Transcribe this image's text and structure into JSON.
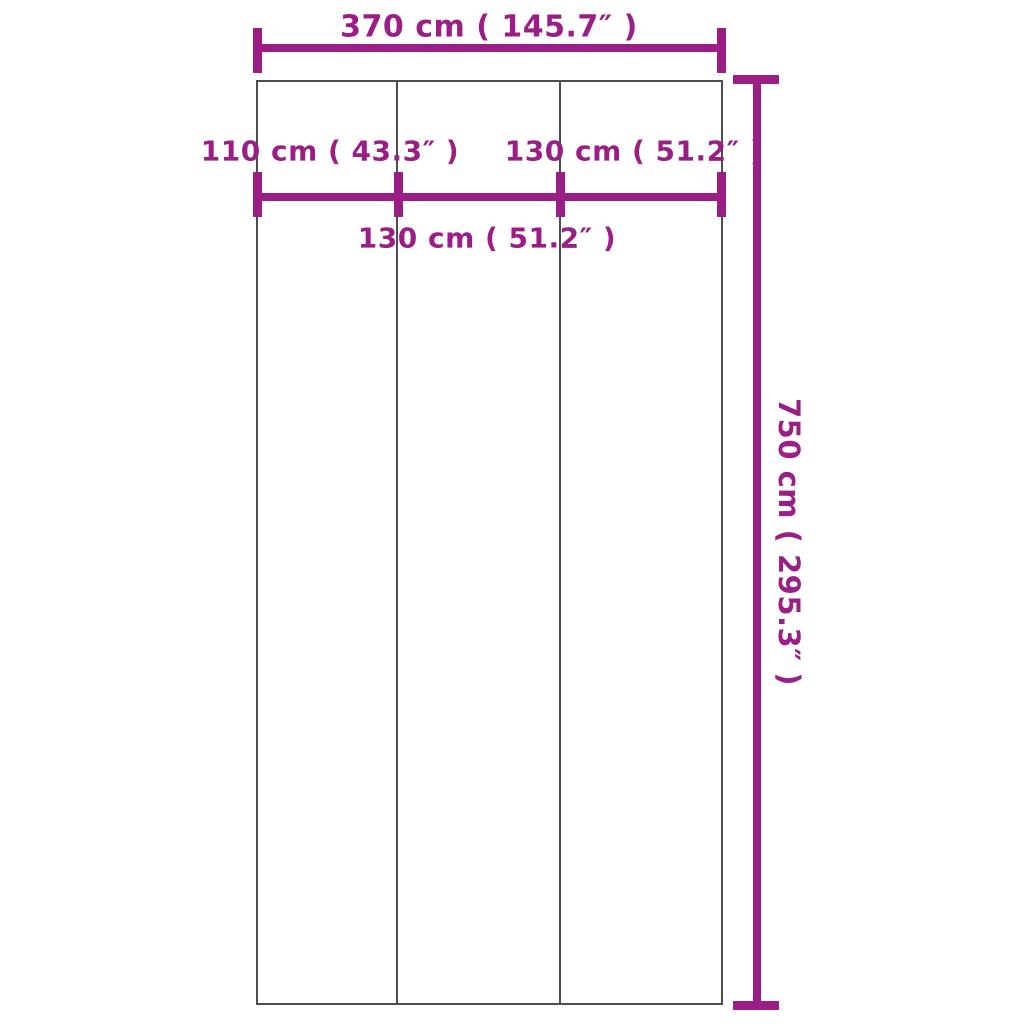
{
  "diagram": {
    "type": "product-dimension-diagram",
    "description": "Rectangular cover divided into three vertical panels with width and height dimension lines",
    "panel_count": 3
  },
  "measurements": {
    "overall_width": {
      "cm": 370,
      "inches": 145.7,
      "label": "370 cm ( 145.7″ )"
    },
    "left_panel_width": {
      "cm": 110,
      "inches": 43.3,
      "label": "110 cm ( 43.3″ )"
    },
    "middle_panel_width": {
      "cm": 130,
      "inches": 51.2,
      "label": "130 cm ( 51.2″ )"
    },
    "right_panel_width": {
      "cm": 130,
      "inches": 51.2,
      "label": "130 cm ( 51.2″ )"
    },
    "overall_height": {
      "cm": 750,
      "inches": 295.3,
      "label": "750 cm ( 295.3″ )"
    }
  },
  "colors": {
    "dimension": "#9B1E87",
    "outline": "#4d4d4d",
    "background": "#ffffff"
  }
}
